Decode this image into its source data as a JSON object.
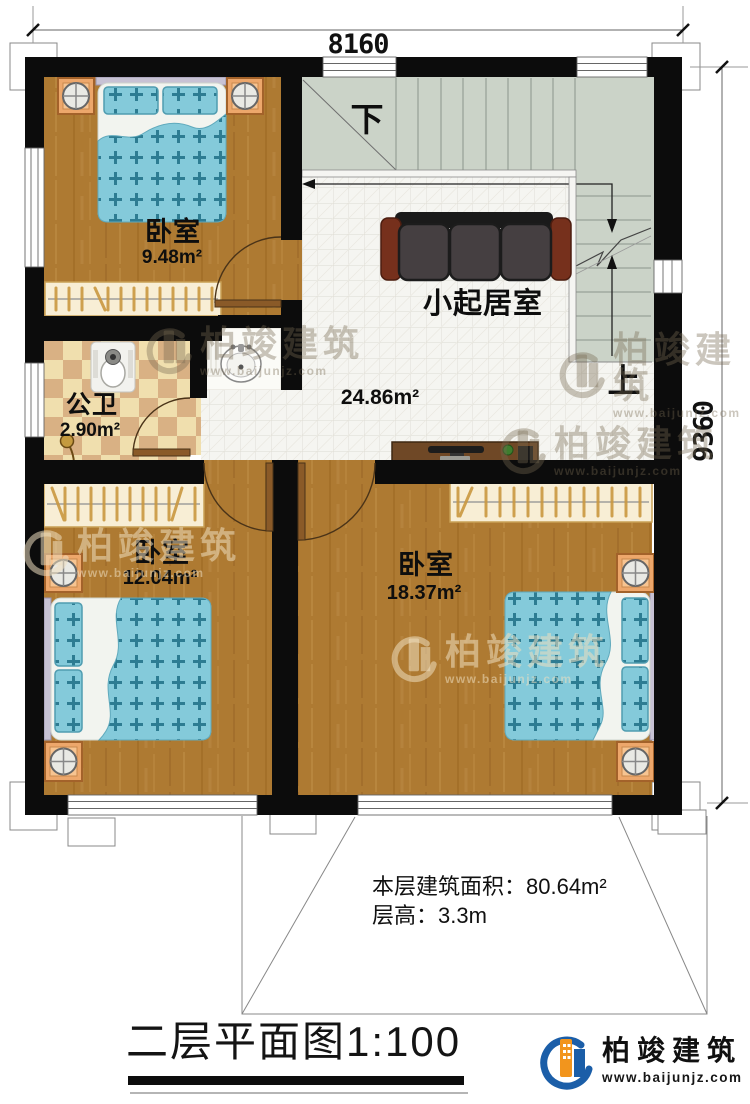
{
  "plan": {
    "dimensions": {
      "top": "8160",
      "right": "9360"
    },
    "rooms": {
      "bedroom_top": {
        "name": "卧室",
        "area": "9.48m²"
      },
      "living": {
        "name": "小起居室",
        "area": "24.86m²"
      },
      "bathroom": {
        "name": "公卫",
        "area": "2.90m²"
      },
      "bedroom_left": {
        "name": "卧室",
        "area": "12.04m²"
      },
      "bedroom_right": {
        "name": "卧室",
        "area": "18.37m²"
      }
    },
    "stairs": {
      "down_label": "下",
      "up_label": "上"
    },
    "footer": {
      "floor_area": "本层建筑面积：80.64m²",
      "floor_height": "层高：3.3m"
    },
    "title": {
      "text": "二层平面图",
      "scale": "1:100"
    }
  },
  "brand": {
    "name": "柏竣建筑",
    "url": "www.baijunjz.com"
  },
  "colors": {
    "wall": "#0c0c0c",
    "wood_floor": "#ae7a32",
    "tile_floor": "#f5f5f1",
    "stair_floor": "#cbd3c8",
    "checker_light": "#f0dfae",
    "checker_dark": "#d9b184",
    "bed_blue": "#84cada",
    "nightstand_orange": "#eda76b",
    "sofa_gray": "#453f41",
    "sofa_arm_brown": "#76301c",
    "logo_blue": "#1b5ea8",
    "logo_orange": "#f2951d"
  }
}
